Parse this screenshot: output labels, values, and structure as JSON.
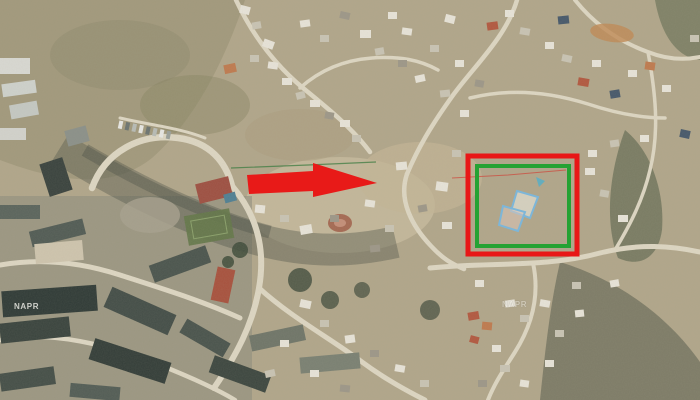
{
  "map": {
    "type": "satellite-aerial-imagery",
    "description": "Aerial cadastral view of a hillside settlement with a land parcel highlighted by a red arrow and a red/green rectangle",
    "watermarks": [
      {
        "text": "NAPR"
      },
      {
        "text": "NAPR"
      }
    ]
  },
  "annotations": {
    "colors": {
      "arrow_red": "#e81a18",
      "rect_red": "#e81717",
      "rect_green": "#25a233",
      "parcel_blue": "#7db6d8"
    },
    "pointer_arrow": {
      "color": "#e81a18",
      "points": [
        [
          247,
          175
        ],
        [
          313,
          171
        ],
        [
          313,
          163
        ],
        [
          377,
          183
        ],
        [
          313,
          197
        ],
        [
          313,
          191
        ],
        [
          249,
          194
        ]
      ]
    },
    "highlight_outer": {
      "color": "#e81717",
      "x": 468,
      "y": 156,
      "width": 109,
      "height": 98,
      "stroke_width": 5
    },
    "highlight_inner": {
      "color": "#25a233",
      "x": 477,
      "y": 166,
      "width": 92,
      "height": 80,
      "stroke_width": 4
    },
    "parcels": [
      {
        "stroke": "#7db6d8",
        "fill": "rgba(238,238,232,0.55)",
        "points": [
          [
            517,
            191
          ],
          [
            538,
            197
          ],
          [
            530,
            218
          ],
          [
            511,
            211
          ]
        ]
      },
      {
        "stroke": "#7db6d8",
        "fill": "rgba(219,196,186,0.55)",
        "points": [
          [
            503,
            206
          ],
          [
            525,
            212
          ],
          [
            518,
            231
          ],
          [
            499,
            225
          ]
        ]
      }
    ],
    "marker_dot": {
      "fill": "#58aec6",
      "points": [
        [
          536,
          177
        ],
        [
          545,
          181
        ],
        [
          539,
          187
        ]
      ]
    },
    "boundary_lines": [
      {
        "stroke": "#3e7c42",
        "width": 1.2,
        "opacity": 0.75,
        "points": [
          [
            231,
            168
          ],
          [
            308,
            165
          ],
          [
            376,
            162
          ]
        ]
      },
      {
        "stroke": "#cf4439",
        "width": 1.1,
        "opacity": 0.7,
        "points": [
          [
            452,
            178
          ],
          [
            508,
            175
          ],
          [
            566,
            170
          ]
        ]
      }
    ]
  }
}
